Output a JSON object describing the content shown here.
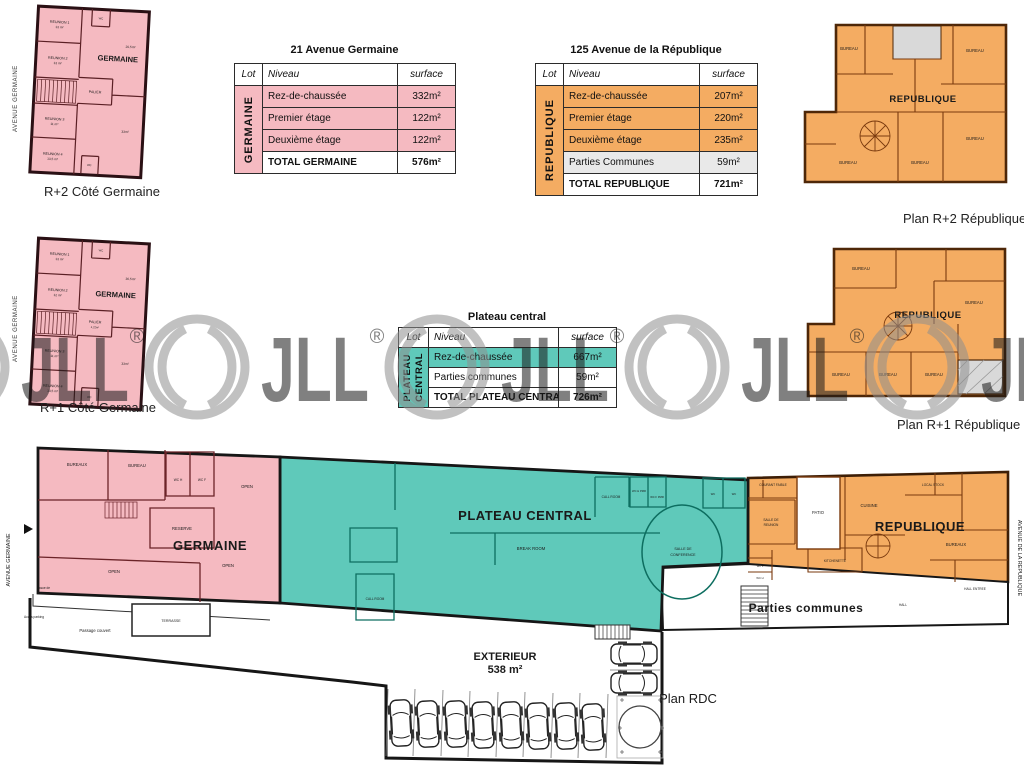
{
  "watermark": {
    "text": "JLL",
    "reg": "®"
  },
  "colors": {
    "pink": "#F5BAC1",
    "orange": "#F4AC62",
    "teal": "#5FC9BA",
    "gray_row": "#E9E9E9",
    "wall_dark": "#1d1d1d",
    "wall_brown": "#7a3a0e",
    "watermark_gray": "#8f8f8f"
  },
  "captions": {
    "r2g": "R+2 Côté Germaine",
    "r1g": "R+1 Côté Germaine",
    "r2r": "Plan R+2 République",
    "r1r": "Plan R+1 République",
    "rdc": "Plan RDC"
  },
  "streets": {
    "germaine": "AVENUE GERMAINE",
    "republique": "AVENUE DE LA REPUBLIQUE"
  },
  "tables": {
    "germaine": {
      "title": "21 Avenue Germaine",
      "headers": {
        "lot": "Lot",
        "niveau": "Niveau",
        "surface": "surface"
      },
      "lot_label": "GERMAINE",
      "rows": [
        [
          "Rez-de-chaussée",
          "332m²"
        ],
        [
          "Premier étage",
          "122m²"
        ],
        [
          "Deuxième étage",
          "122m²"
        ]
      ],
      "total": [
        "TOTAL GERMAINE",
        "576m²"
      ]
    },
    "republique": {
      "title": "125 Avenue de la République",
      "headers": {
        "lot": "Lot",
        "niveau": "Niveau",
        "surface": "surface"
      },
      "lot_label": "REPUBLIQUE",
      "rows": [
        [
          "Rez-de-chaussée",
          "207m²"
        ],
        [
          "Premier étage",
          "220m²"
        ],
        [
          "Deuxième étage",
          "235m²"
        ],
        [
          "Parties Communes",
          "59m²"
        ]
      ],
      "total": [
        "TOTAL REPUBLIQUE",
        "721m²"
      ]
    },
    "plateau": {
      "title": "Plateau central",
      "headers": {
        "lot": "Lot",
        "niveau": "Niveau",
        "surface": "surface"
      },
      "lot_l1": "PLATEAU",
      "lot_l2": "CENTRAL",
      "rows": [
        [
          "Rez-de-chaussée",
          "667m²"
        ],
        [
          "Parties communes",
          "59m²"
        ]
      ],
      "total": [
        "TOTAL PLATEAU CENTRAL",
        "726m²"
      ]
    }
  },
  "plans": {
    "r2g": {
      "name": "GERMAINE",
      "rooms": {
        "reunion1": "REUNION 1",
        "reunion1_a": "13 m²",
        "reunion2": "REUNION 2",
        "reunion2_a": "13 m²",
        "reunion3": "REUNION 3",
        "reunion3_a": "11 m²",
        "reunion4": "REUNION 4",
        "reunion4_a": "13,5 m²",
        "palier": "PALIER",
        "wc": "WC",
        "area_top": "20,5m²",
        "area_bottom": "33m²"
      }
    },
    "r1g": {
      "name": "GERMAINE",
      "rooms": {
        "reunion1": "REUNION 1",
        "reunion1_a": "13 m²",
        "reunion2": "REUNION 2",
        "reunion2_a": "12 m²",
        "reunion3": "REUNION 3",
        "reunion3_a": "11 m²",
        "reunion4": "REUNION 4",
        "reunion4_a": "13,5 m²",
        "palier": "PALIER",
        "palier_a": "4,22m²",
        "wc": "WC",
        "area_top": "36,5m²",
        "area_bottom": "33m²"
      }
    },
    "r2r": {
      "name": "REPUBLIQUE",
      "room": "BUREAU"
    },
    "r1r": {
      "name": "REPUBLIQUE",
      "room": "BUREAU"
    }
  },
  "rdc": {
    "germaine": {
      "name": "GERMAINE",
      "bureaux": "BUREAUX",
      "bureau": "BUREAU",
      "wch": "WC H",
      "wcf": "WC F",
      "reserve": "RESERVE",
      "open": "OPEN"
    },
    "plateau": {
      "name": "PLATEAU CENTRAL",
      "break_room": "BREAK ROOM",
      "call_room": "CALL ROOM",
      "conf_l1": "SALLE DE",
      "conf_l2": "CONFERENCE",
      "wch_pmr": "WC H PMR",
      "wcf_pmr": "WC F PMR",
      "wc": "WC"
    },
    "republique": {
      "name": "REPUBLIQUE",
      "courant": "COURANT FAIBLE",
      "reunion_l1": "SALLE DE",
      "reunion_l2": "REUNION",
      "patio": "PATIO",
      "cuisine": "CUISINE",
      "local_stock": "LOCAL STOCK",
      "bureaux": "BUREAUX",
      "kitchenette": "KITCHENETTE",
      "wcf": "WC F",
      "wch": "WC H",
      "hall_entree": "HALL ENTREE",
      "hall": "HALL"
    },
    "commons": "Parties communes",
    "exterieur_l1": "EXTERIEUR",
    "exterieur_l2": "538 m²",
    "terrasse": "TERRASSE",
    "passage": "Passage couvert",
    "issue_l1": "Issue de",
    "issue_l2": "secours",
    "acces": "Accès parking"
  }
}
